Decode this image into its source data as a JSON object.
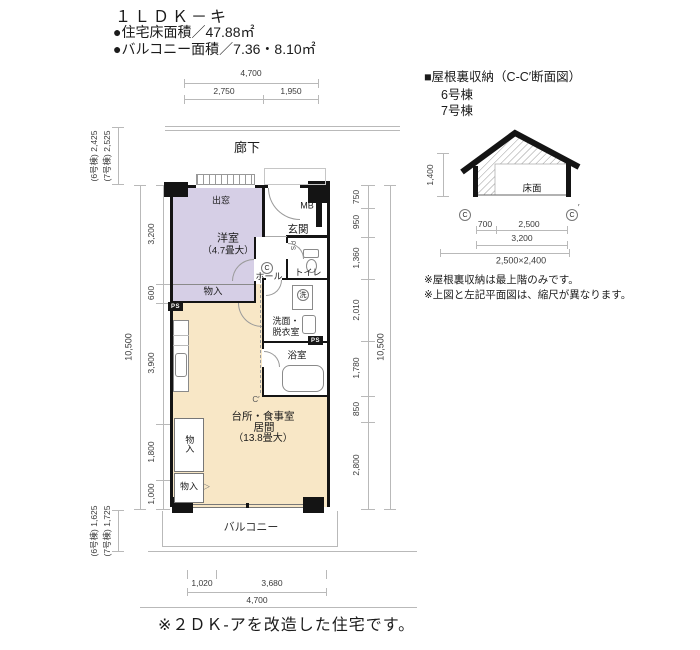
{
  "title": {
    "name": "１ＬＤＫ－キ",
    "floor_area": "●住宅床面積／47.88㎡",
    "balcony_area": "●バルコニー面積／7.36・8.10㎡"
  },
  "plan": {
    "corridor": "廊下",
    "balcony": "バルコニー",
    "rooms": {
      "bay": "出窓",
      "western": "洋室",
      "western_size": "（4.7畳大）",
      "entrance": "玄関",
      "mb": "MB",
      "hall": "ホール",
      "toilet": "トイレ",
      "washer": "洗",
      "washroom": "洗面・\n脱衣室",
      "bath": "浴室",
      "ldk_l1": "台所・食事室",
      "ldk_l2": "居間",
      "ldk_size": "（13.8畳大）",
      "closet": "物入",
      "ps": "PS",
      "c": "C",
      "c_prime": "C′"
    },
    "dims": {
      "top_total": "4,700",
      "top_segs": [
        "2,750",
        "1,950"
      ],
      "left_outer_top": [
        "(6号棟) 2,425",
        "(7号棟) 2,525"
      ],
      "left_total": "10,500",
      "left_segs": [
        "3,200",
        "600",
        "3,900",
        "1,800",
        "1,000"
      ],
      "right_total": "10,500",
      "right_segs": [
        "750",
        "950",
        "1,360",
        "2,010",
        "1,780",
        "850",
        "2,800"
      ],
      "left_outer_bottom": [
        "(6号棟) 1,625",
        "(7号棟) 1,725"
      ],
      "bottom_total": "4,700",
      "bottom_segs": [
        "1,020",
        "3,680"
      ]
    }
  },
  "section": {
    "heading": "■屋根裏収納（C-C′断面図）",
    "building_6": "6号棟",
    "building_7": "7号棟",
    "floor_label": "床面",
    "height": "1,400",
    "c": "C",
    "prime": "′",
    "dim_700": "700",
    "dim_2500": "2,500",
    "dim_3200": "3,200",
    "dim_overall": "2,500×2,400",
    "note1": "※屋根裏収納は最上階のみです。",
    "note2": "※上図と左記平面図は、縮尺が異なります。"
  },
  "footer": {
    "note": "※２ＤＫ-アを改造した住宅です。"
  },
  "colors": {
    "western": "#d6cfe6",
    "ldk": "#f8e7c6",
    "wall": "#141414"
  }
}
